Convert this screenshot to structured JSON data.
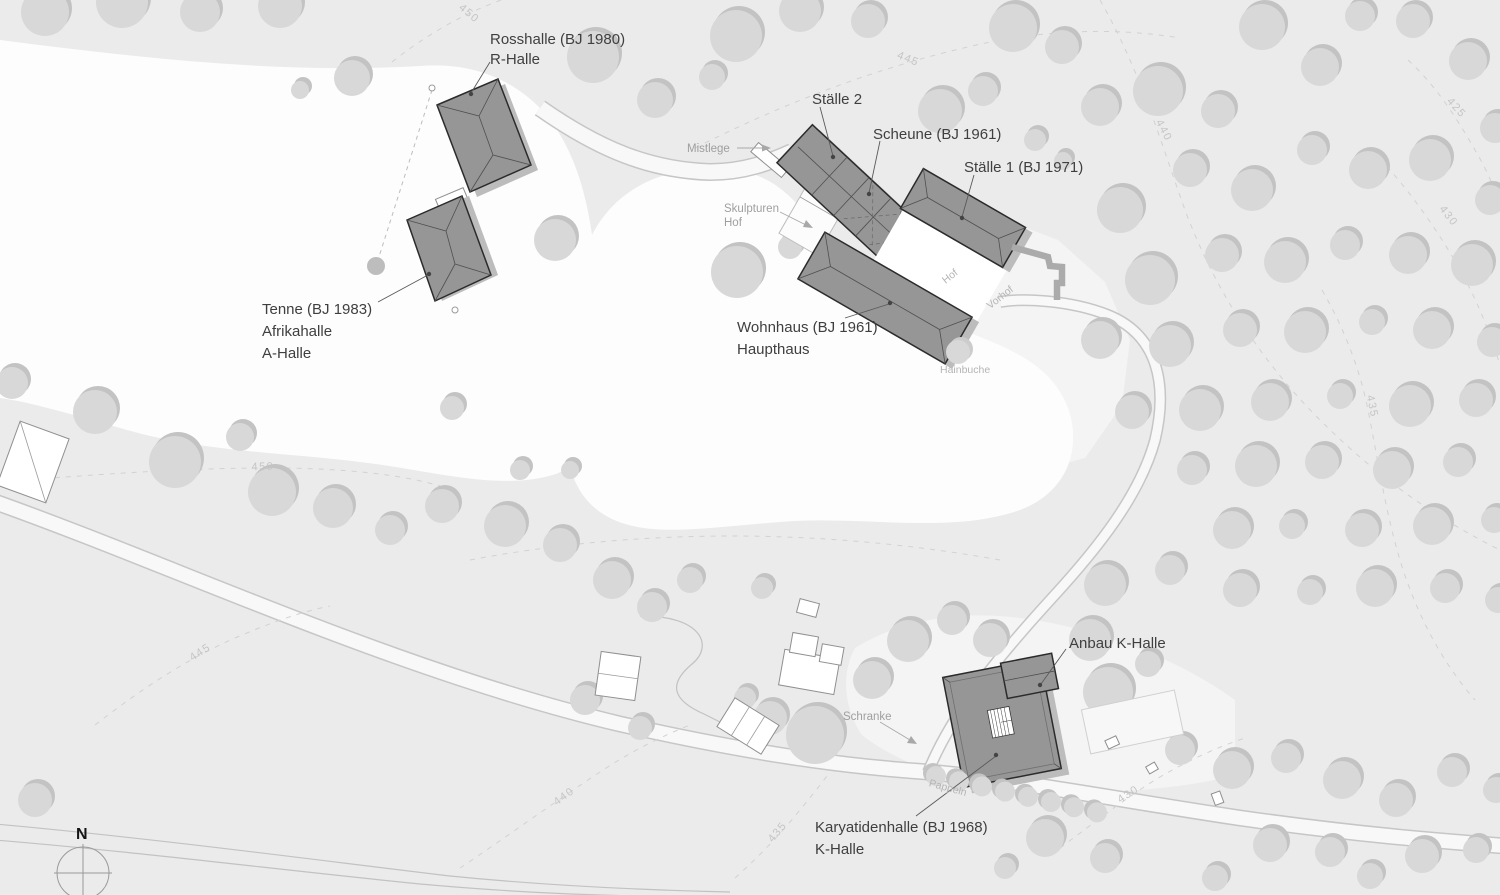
{
  "colors": {
    "background": "#ebebeb",
    "field": "#fdfdfd",
    "pale_field": "#f4f4f4",
    "tree": "#d8d8d8",
    "tree_shadow": "#c3c3c3",
    "building": "#969696",
    "building_outline": "#2b2b2b",
    "building_shadow": "#bcbcbc",
    "label_dark": "#3f3f3f",
    "label_gray": "#9f9f9f",
    "contour_label": "#c5c5c5"
  },
  "buildings": [
    {
      "id": "rosshalle",
      "label_line1": "Rosshalle (BJ 1980)",
      "label_line2": "R-Halle"
    },
    {
      "id": "staelle-2",
      "label_line1": "Ställe 2"
    },
    {
      "id": "scheune",
      "label_line1": "Scheune (BJ 1961)"
    },
    {
      "id": "staelle-1",
      "label_line1": "Ställe 1 (BJ 1971)"
    },
    {
      "id": "tenne",
      "label_line1": "Tenne (BJ 1983)",
      "label_line2": "Afrikahalle",
      "label_line3": "A-Halle"
    },
    {
      "id": "wohnhaus",
      "label_line1": "Wohnhaus (BJ 1961)",
      "label_line2": "Haupthaus"
    },
    {
      "id": "anbau-k-halle",
      "label_line1": "Anbau K-Halle"
    },
    {
      "id": "karyatidenhalle",
      "label_line1": "Karyatidenhalle (BJ 1968)",
      "label_line2": "K-Halle"
    }
  ],
  "annotations": {
    "mistlege": "Mistlege",
    "skulpturen_hof_line1": "Skulpturen",
    "skulpturen_hof_line2": "Hof",
    "hof": "Hof",
    "vorhof": "Vorhof",
    "hainbuche": "Hainbuche",
    "schranke": "Schranke",
    "pappeln": "Pappeln"
  },
  "contours": {
    "c450_top": "450",
    "c445_top": "445",
    "c440_right": "440",
    "c425_right": "425",
    "c430_right": "430",
    "c435_right": "435",
    "c450_left": "450",
    "c445_left": "445",
    "c440_bottom": "440",
    "c435_bottom": "435",
    "c430_bottom": "430"
  },
  "compass": {
    "north": "N"
  }
}
